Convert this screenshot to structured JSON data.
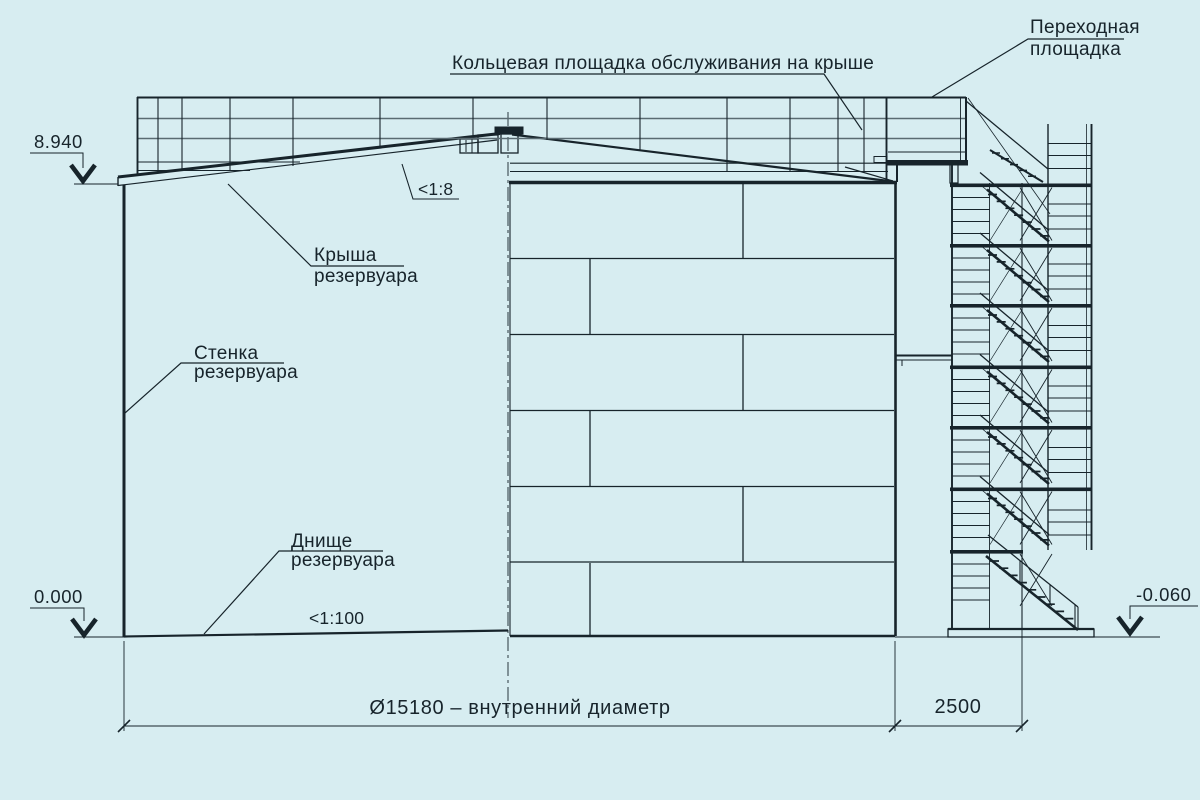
{
  "drawing": {
    "type": "tank-cross-section-technical-drawing",
    "colors": {
      "background": "#d7edf1",
      "line": "#17242b",
      "rail_gray": "#5a6b72"
    },
    "labels": {
      "ring_platform": "Кольцевая площадка обслуживания на крыше",
      "transition_platform_line1": "Переходная",
      "transition_platform_line2": "площадка",
      "roof_line1": "Крыша",
      "roof_line2": "резервуара",
      "wall_line1": "Стенка",
      "wall_line2": "резервуара",
      "bottom_line1": "Днище",
      "bottom_line2": "резервуара",
      "roof_slope": "<1:8",
      "bottom_slope": "<1:100"
    },
    "elevation_marks": {
      "roof_top": "8.940",
      "zero_level": "0.000",
      "ground_level": "-0.060"
    },
    "dimensions": {
      "inner_diameter": "Ø15180 – внутренний диаметр",
      "stair_offset": "2500"
    }
  }
}
